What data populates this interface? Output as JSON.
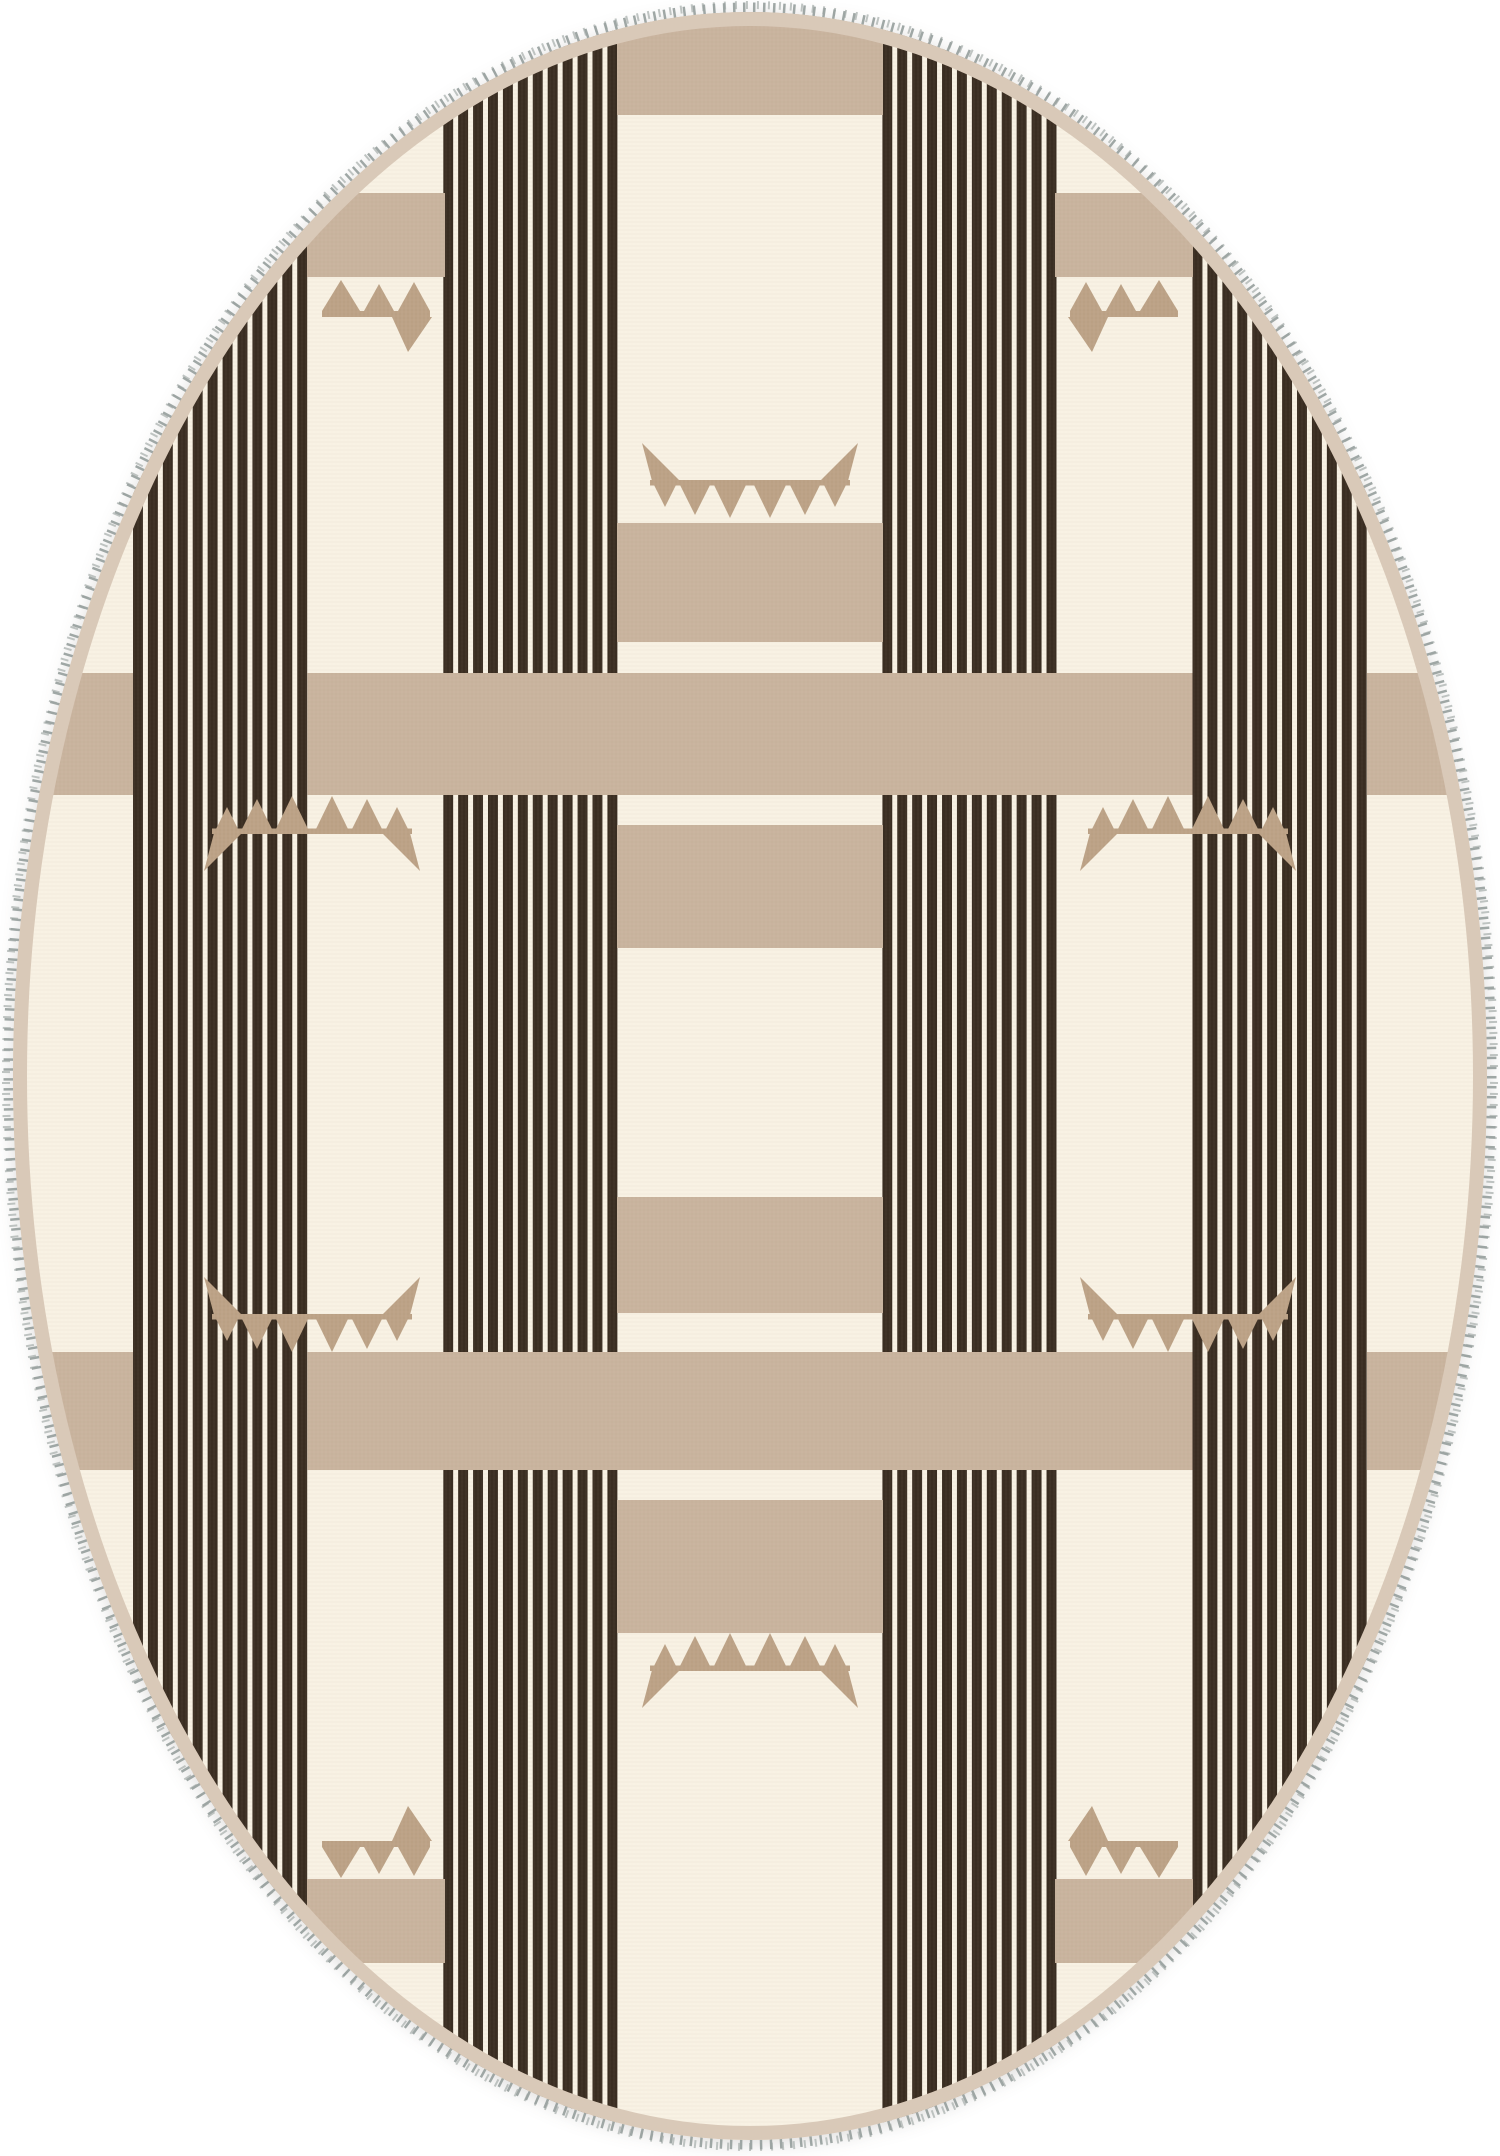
{
  "page": {
    "title": "Oval Striped Kilim Rug",
    "description": "Cream oval flat-weave rug with columns of thin dark-brown pinstripes, wide tan cross bands, tan blocks and triangle pennant motifs, finished with a grey whipstitch edge and tan binding."
  },
  "rug": {
    "shape": "oval",
    "colors": {
      "cream": "#f8f1e3",
      "stripe_brown": "#3a2d21",
      "band_tan": "#c9b39e",
      "motif_tan": "#bca286",
      "binding_tan": "#d9c9b8",
      "stitch_gray": "#9aa2a0",
      "stitch_gray_light": "#b4bab7",
      "page_white": "#ffffff"
    },
    "stripe_period": "14.93",
    "stripe_dark_width": "9.95",
    "stripes_per_group": 12,
    "stripe_groups": [
      {
        "name": "outer-left",
        "x": "133",
        "width": "174.5"
      },
      {
        "name": "inner-left",
        "x": "443.2",
        "width": "174.5"
      },
      {
        "name": "inner-right",
        "x": "882.3",
        "width": "174.5"
      },
      {
        "name": "outer-right",
        "x": "1192.5",
        "width": "174.5"
      }
    ],
    "bands": [
      {
        "name": "upper",
        "y": "673",
        "height": "122"
      },
      {
        "name": "lower",
        "y": "1352",
        "height": "118"
      }
    ],
    "center_column": {
      "x": "617",
      "width": "266",
      "top_arc_height": "115",
      "blocks": [
        {
          "y": "523",
          "height": "119"
        },
        {
          "y": "825",
          "height": "123"
        },
        {
          "y": "1197",
          "height": "116"
        },
        {
          "y": "1500",
          "height": "133"
        }
      ]
    },
    "gap_block": {
      "width": "138",
      "height": "84"
    },
    "gap_blocks": [
      {
        "pos": "top-left",
        "x": "307",
        "y": "193"
      },
      {
        "pos": "top-right",
        "x": "1055",
        "y": "193"
      },
      {
        "pos": "bottom-left",
        "x": "307",
        "y": "1879"
      },
      {
        "pos": "bottom-right",
        "x": "1055",
        "y": "1879"
      }
    ],
    "motif_full_count": 6,
    "motif_half_count": 4
  }
}
